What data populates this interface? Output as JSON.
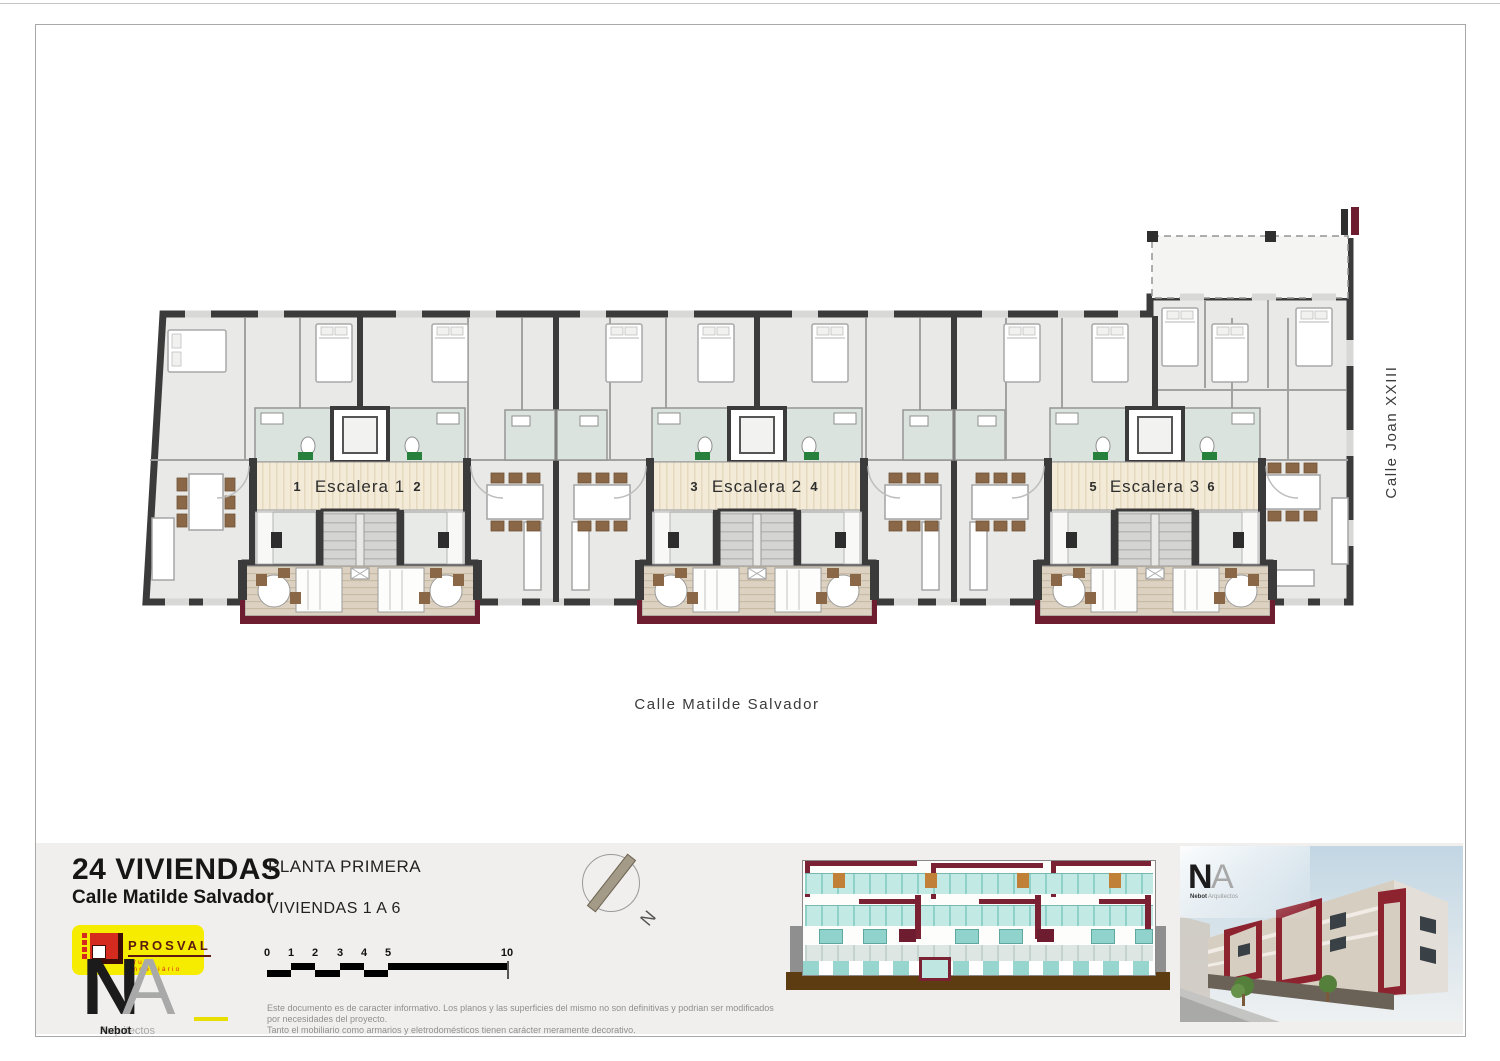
{
  "plan": {
    "cores": [
      {
        "label": "Escalera 1"
      },
      {
        "label": "Escalera 2"
      },
      {
        "label": "Escalera 3"
      }
    ],
    "units": [
      "1",
      "2",
      "3",
      "4",
      "5",
      "6"
    ],
    "streets": {
      "bottom": "Calle Matilde Salvador",
      "right": "Calle Joan XXIII"
    }
  },
  "titleblock": {
    "project": "24 VIVIENDAS",
    "address": "Calle Matilde Salvador",
    "sheet": "PLANTA PRIMERA",
    "subtitle": "VIVIENDAS 1 A 6"
  },
  "prosval": {
    "name": "PROSVAL",
    "tagline": "grupo imobiliário"
  },
  "na": {
    "n": "N",
    "a": "A",
    "firm_bold": "Nebot",
    "firm_light": "Arquitectos"
  },
  "north": {
    "label": "N"
  },
  "scalebar": {
    "ticks": [
      "0",
      "1",
      "2",
      "3",
      "4",
      "5",
      "10"
    ]
  },
  "disclaimer": {
    "line1": "Este documento es de caracter informativo. Los planos y las superficies del mismo no son definitivas y podrian ser modificados por necesidades del proyecto.",
    "line2": "Tanto el mobiliario como armarios y eletrodomésticos tienen carácter meramente decorativo."
  },
  "render_logo": {
    "n": "N",
    "a": "A",
    "firm_bold": "Nebot",
    "firm_light": "Arquitectos"
  },
  "colors": {
    "wall": "#3b3b3b",
    "floor": "#e9e9e7",
    "bath": "#dbe3de",
    "corridor": "#f3ebd8",
    "balcony_tan": "#ddd2c1",
    "railing_maroon": "#6e1c2f",
    "glass_teal": "#8fd0c9",
    "prosval_yellow": "#f6ec00",
    "prosval_red": "#d42b1e"
  }
}
